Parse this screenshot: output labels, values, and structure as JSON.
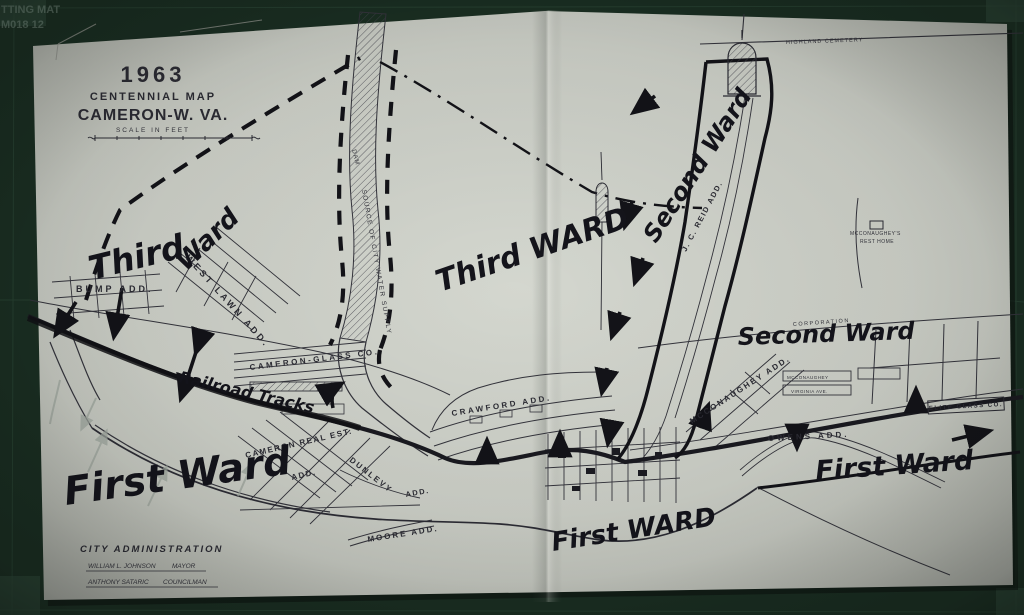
{
  "mat": {
    "label_line1": "TTING MAT",
    "label_line2": "M018 12"
  },
  "title_block": {
    "year": "1963",
    "subtitle": "CENTENNIAL MAP",
    "city": "CAMERON-W. VA.",
    "scale_label": "SCALE IN FEET"
  },
  "admin_block": {
    "heading": "CITY ADMINISTRATION",
    "line1_name": "WILLIAM L. JOHNSON",
    "line1_title": "MAYOR",
    "line2_name": "ANTHONY SATARIC",
    "line2_title": "COUNCILMAN"
  },
  "handwritten": {
    "third_ward_left_word1": "Third",
    "third_ward_left_word2": "Ward",
    "third_ward_center": "Third WARD",
    "second_ward_diag": "Second Ward",
    "second_ward_right": "Second Ward",
    "first_ward_left": "First Ward",
    "first_ward_center": "First WARD",
    "first_ward_right": "First Ward",
    "railroad_tracks": "Railroad Tracks"
  },
  "printed_labels": {
    "bump_add": "BUMP ADD.",
    "west_lawn_add": "WEST LAWN ADD.",
    "cameron_glass": "CAMERON-GLASS CO.",
    "crawford_add": "CRAWFORD ADD.",
    "cameron_real_est": "CAMERON REAL EST.",
    "cameron_real_est_add": "ADD.",
    "dunlevy": "DUNLEVY",
    "dunlevy_add": "ADD.",
    "moore_add": "MOORE ADD.",
    "owens_add": "OWENS ADD.",
    "mcconaughey_add": "MCCONAUGHEY ADD.",
    "jc_reid_add": "J. C. REID ADD.",
    "highland_cemetery": "HIGHLAND CEMETERY",
    "rest_home_line1": "MCCONAUGHEY'S",
    "rest_home_line2": "REST HOME",
    "elite_glass": "ELITE GLASS CO.",
    "water_supply": "SOURCE OF CITY WATER SUPPLY",
    "dam": "DAM",
    "corporation": "CORPORATION",
    "block_mcconaughey": "MCCONAUGHEY",
    "block_virginia": "VIRGINIA AVE."
  },
  "colors": {
    "mat_green": "#1a2e22",
    "paper": "#ced1c9",
    "printed_ink": "#2b2b33",
    "marker_ink": "#131318",
    "pencil": "#9aa29a"
  }
}
